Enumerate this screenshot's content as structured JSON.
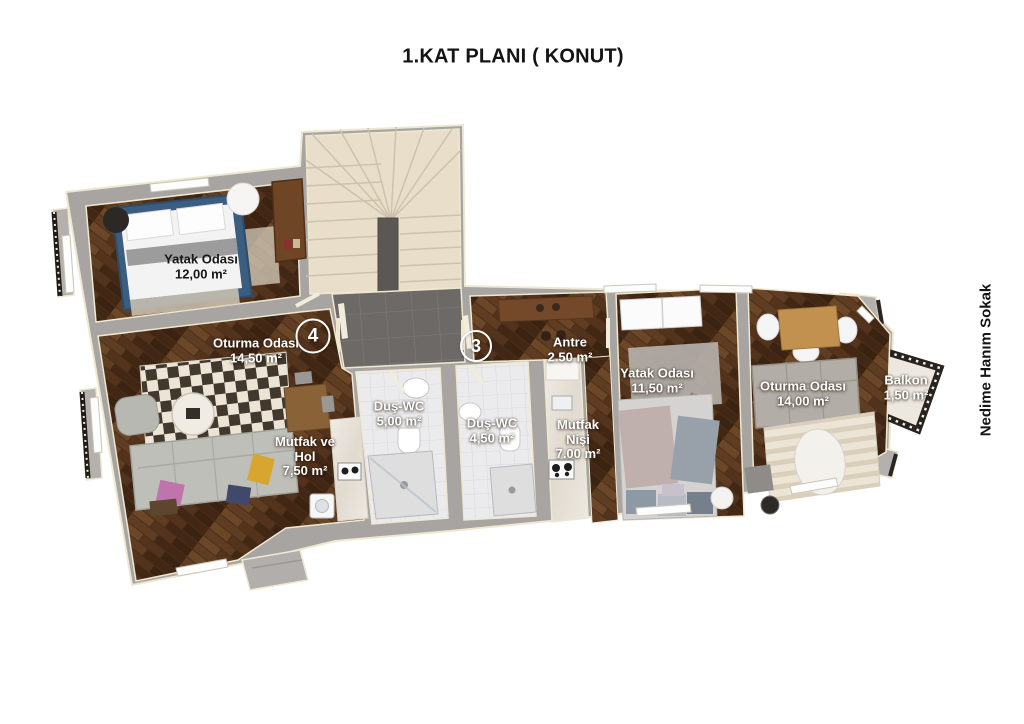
{
  "title": "1.KAT PLANI ( KONUT)",
  "street_label": "Nedime Hanım Sokak",
  "units": [
    {
      "number": "4"
    },
    {
      "number": "3"
    }
  ],
  "rooms": [
    {
      "name": "Yatak Odası",
      "area": "12,00 m²"
    },
    {
      "name": "Oturma Odası",
      "area": "14,50 m²"
    },
    {
      "name": "Mutfak ve Hol",
      "area": "7,50 m²"
    },
    {
      "name": "Duş-WC",
      "area": "5,00 m²"
    },
    {
      "name": "Duş-WC",
      "area": "4,50 m²"
    },
    {
      "name": "Antre",
      "area": "2.50 m²"
    },
    {
      "name": "Mutfak Nişi",
      "area": "7.00 m²"
    },
    {
      "name": "Yatak Odası",
      "area": "11,50 m²"
    },
    {
      "name": "Oturma Odası",
      "area": "14,00 m²"
    },
    {
      "name": "Balkon",
      "area": "1,50 m²"
    }
  ],
  "colors": {
    "background": "#ffffff",
    "wall_gray": "#a7a4a2",
    "wall_trim_cream": "#efe8d0",
    "wood_floor": "#4b2e1a",
    "stair_marble": "#e8decab",
    "landing_tile": "#6d6967",
    "bath_tile": "#ebebed",
    "label_text": "#ffffff",
    "bed_blue": "#3a5d80"
  }
}
